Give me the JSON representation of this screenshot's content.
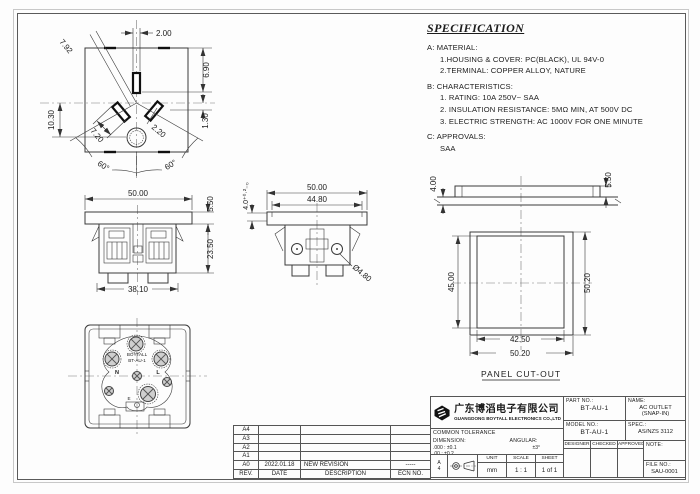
{
  "specification": {
    "title": "SPECIFICATION",
    "lines": [
      "A:  MATERIAL:",
      "1.HOUSING & COVER:  PC(BLACK), UL 94V-0",
      "2.TERMINAL:  COPPER ALLOY, NATURE",
      "B:  CHARACTERISTICS:",
      "1. RATING:  10A 250V~ SAA",
      "2. INSULATION RESISTANCE:  5MΩ MIN, AT 500V DC",
      "3. ELECTRIC STRENGTH:  AC 1000V FOR ONE MINUTE",
      "C:  APPROVALS:",
      "SAA"
    ]
  },
  "front_view": {
    "dim_slot_top_width": "2.00",
    "dim_slot_diag_length": "7.92",
    "dim_top_to_slot": "6.90",
    "dim_center_to_bottom": "10.30",
    "dim_offset": "1.30",
    "dim_slot_width": "2.20",
    "dim_slot_length": "7.20",
    "angle_left": "60°",
    "angle_right": "60°"
  },
  "front_elevation": {
    "dim_width": "50.00",
    "dim_flange_height": "5.50",
    "dim_body_height": "23.50",
    "dim_bottom_width": "38.10"
  },
  "side_elevation": {
    "dim_width": "50.00",
    "dim_inner_width": "44.80",
    "dim_flange_thickness": "4.0⁺⁰·²₋₀",
    "dim_hole_dia": "Ø4.80"
  },
  "rear_view": {
    "brand": "BOYTALL",
    "model": "BT-AU-1",
    "terminal_n": "N",
    "terminal_l": "L",
    "terminal_e": "E"
  },
  "panel_cutout": {
    "label": "PANEL CUT-OUT",
    "dim_panel_thickness": "4.00",
    "dim_flange_height": "5.50",
    "dim_inner_height": "45.00",
    "dim_outer_height": "50.20",
    "dim_inner_width": "42.50",
    "dim_outer_width": "50.20"
  },
  "revision": {
    "headers": {
      "rev": "REV.",
      "date": "DATE",
      "description": "DESCRIPTION",
      "ecn": "ECN NO."
    },
    "rows": [
      {
        "rev": "A4",
        "date": "",
        "description": "",
        "ecn": ""
      },
      {
        "rev": "A3",
        "date": "",
        "description": "",
        "ecn": ""
      },
      {
        "rev": "A2",
        "date": "",
        "description": "",
        "ecn": ""
      },
      {
        "rev": "A1",
        "date": "",
        "description": "",
        "ecn": ""
      },
      {
        "rev": "A0",
        "date": "2022.01.18",
        "description": "NEW REVISION",
        "ecn": "-----"
      }
    ]
  },
  "title_block": {
    "company_cn": "广东博滔电子有限公司",
    "company_en": "GUANGDONG BOYTALL ELECTRONICS CO.,LTD",
    "part_no_label": "PART NO.:",
    "part_no": "BT-AU-1",
    "name_label": "NAME:",
    "name_value_line1": "AC OUTLET",
    "name_value_line2": "(SNAP-IN)",
    "model_no_label": "MODEL NO.:",
    "model_no": "BT-AU-1",
    "spec_label": "SPEC.:",
    "spec_value": "AS/NZS 3112",
    "tolerance_title": "COMMON TOLERANCE",
    "dimension_label": "DIMENSION:",
    "angular_label": "ANGULAR:",
    "angular_value": "±3°",
    "tolerance_rows": [
      ".000 : ±0.1",
      ".00   : ±0.2",
      ".0     : ±0.3"
    ],
    "designer_label": "DESIGNER",
    "checked_label": "CHECKED",
    "approved_label": "APPROVED",
    "note_label": "NOTE:",
    "file_no_label": "FILE NO.:",
    "file_no": "SAU-0001",
    "unit_label": "UNIT",
    "unit_value": "mm",
    "scale_label": "SCALE",
    "scale_value": "1 : 1",
    "sheet_label": "SHEET",
    "sheet_value": "1 of 1",
    "paper_size_line1": "A",
    "paper_size_line2": "4"
  }
}
